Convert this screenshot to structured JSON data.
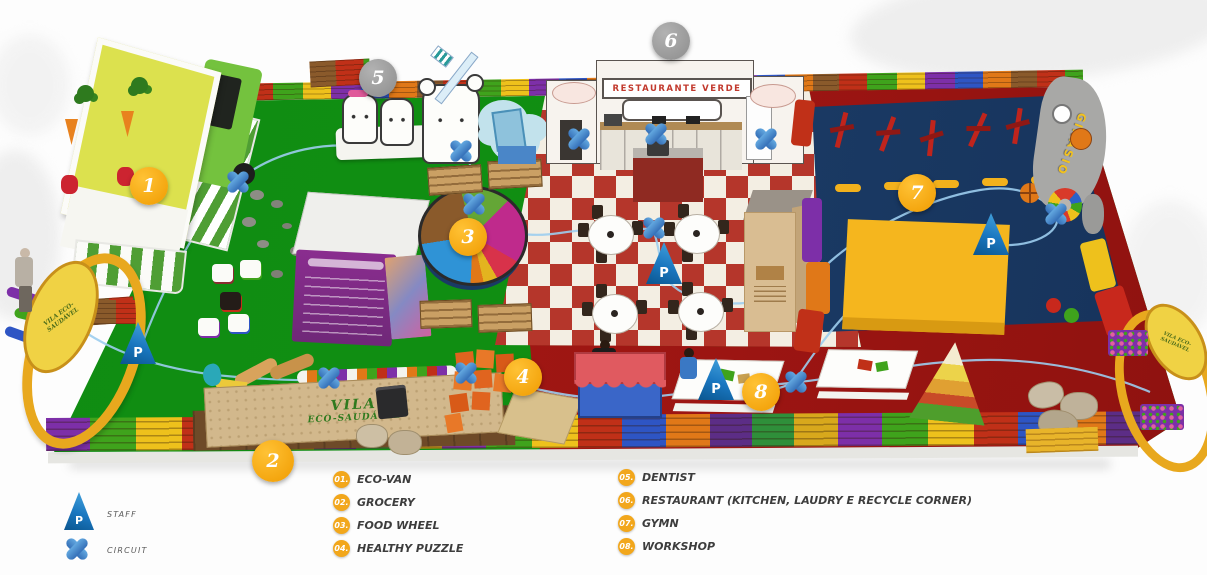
{
  "map": {
    "signs": {
      "restaurant_sign": "RESTAURANTE VERDE",
      "grocery_sign_line1": "VILA",
      "grocery_sign_line2": "ECO-SAUDÁVEL",
      "gym_sign": "GINÁSIO",
      "arch_sign": "VILA ECO-SAUDÁVEL"
    },
    "markers": {
      "staff_symbol": "P"
    },
    "badges": [
      {
        "num": "1",
        "style": "yellow"
      },
      {
        "num": "2",
        "style": "yellow"
      },
      {
        "num": "3",
        "style": "yellow"
      },
      {
        "num": "4",
        "style": "yellow"
      },
      {
        "num": "5",
        "style": "gray"
      },
      {
        "num": "6",
        "style": "gray"
      },
      {
        "num": "7",
        "style": "yellow"
      },
      {
        "num": "8",
        "style": "yellow"
      }
    ]
  },
  "legend": {
    "staff": {
      "symbol": "P",
      "label": "STAFF"
    },
    "circuit": {
      "label": "CIRCUIT"
    },
    "items": [
      {
        "num": "01.",
        "label": "ECO-VAN"
      },
      {
        "num": "02.",
        "label": "GROCERY"
      },
      {
        "num": "03.",
        "label": "FOOD WHEEL"
      },
      {
        "num": "04.",
        "label": "HEALTHY PUZZLE"
      },
      {
        "num": "05.",
        "label": "DENTIST"
      },
      {
        "num": "06.",
        "label": "RESTAURANT (KITCHEN, LAUDRY E RECYCLE CORNER)"
      },
      {
        "num": "07.",
        "label": "GYMN"
      },
      {
        "num": "08.",
        "label": "WORKSHOP"
      }
    ]
  },
  "colors": {
    "badge_yellow": "#F6A800",
    "badge_gray": "#9B9B9B",
    "marker_blue": "#2E86C9",
    "turf_green": "#118F12",
    "checker_red": "#B5362B",
    "floor_red": "#9C1512",
    "gym_navy": "#1A3A64",
    "mat_yellow": "#F2B11C",
    "circuit_line": "#9CCDEE"
  }
}
